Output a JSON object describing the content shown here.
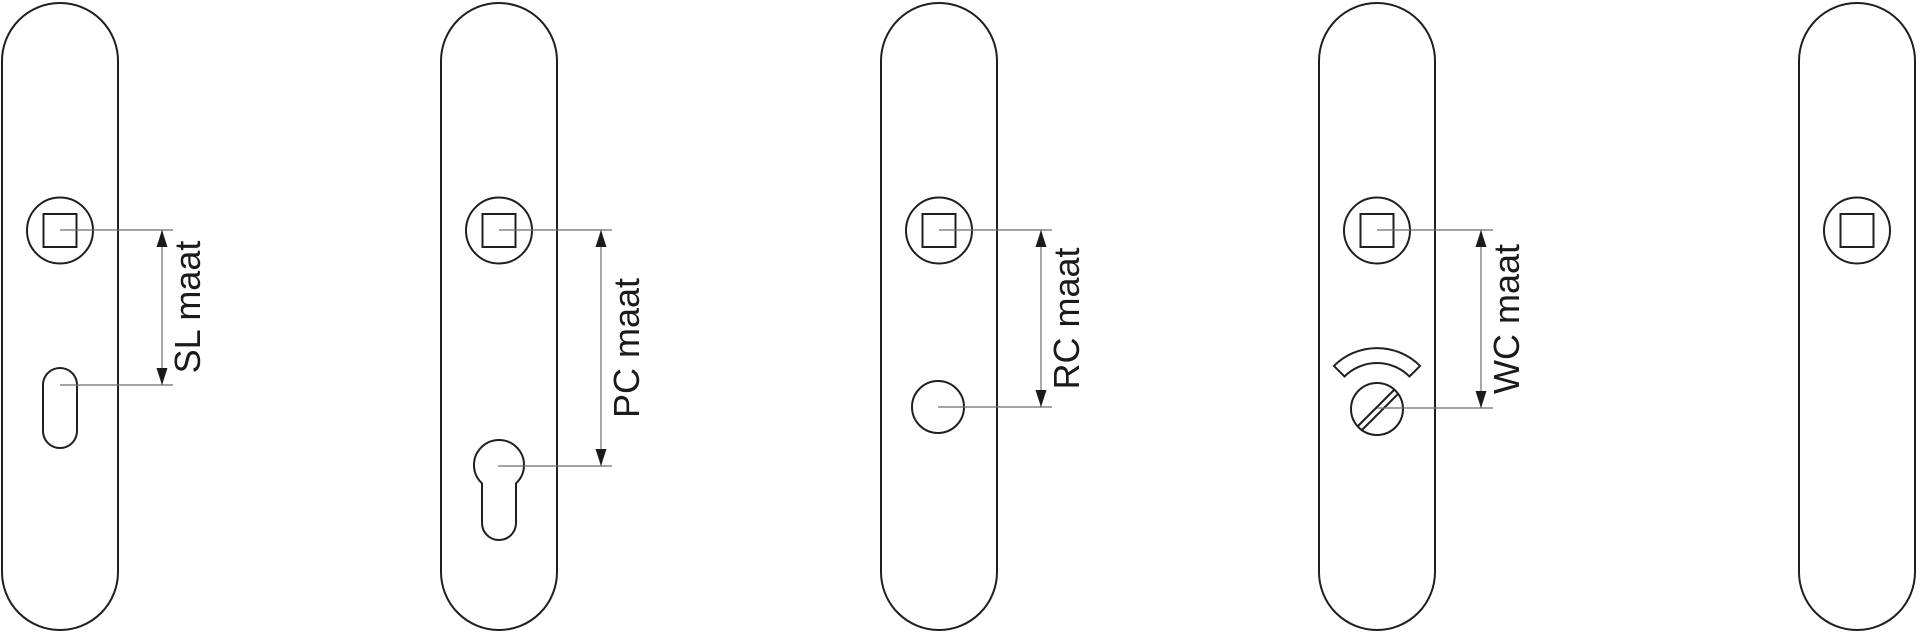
{
  "diagram": {
    "type": "technical-drawing",
    "subject": "door backplate hole configurations",
    "colors": {
      "background": "#ffffff",
      "outline": "#1f1f1f",
      "dimension_line": "#6e6e6e",
      "label_text": "#1a1a1a"
    },
    "plates": [
      {
        "id": "sl",
        "dimension_label": "SL maat",
        "holes": [
          "spindle-square-hole",
          "key-slot-hole"
        ]
      },
      {
        "id": "pc",
        "dimension_label": "PC maat",
        "holes": [
          "spindle-square-hole",
          "euro-cylinder-hole"
        ]
      },
      {
        "id": "rc",
        "dimension_label": "RC maat",
        "holes": [
          "spindle-square-hole",
          "round-cylinder-hole"
        ]
      },
      {
        "id": "wc",
        "dimension_label": "WC maat",
        "holes": [
          "spindle-square-hole",
          "wc-thumbturn-hole",
          "wc-indicator-arc"
        ]
      },
      {
        "id": "blind",
        "dimension_label": "",
        "holes": [
          "spindle-square-hole"
        ]
      }
    ]
  }
}
